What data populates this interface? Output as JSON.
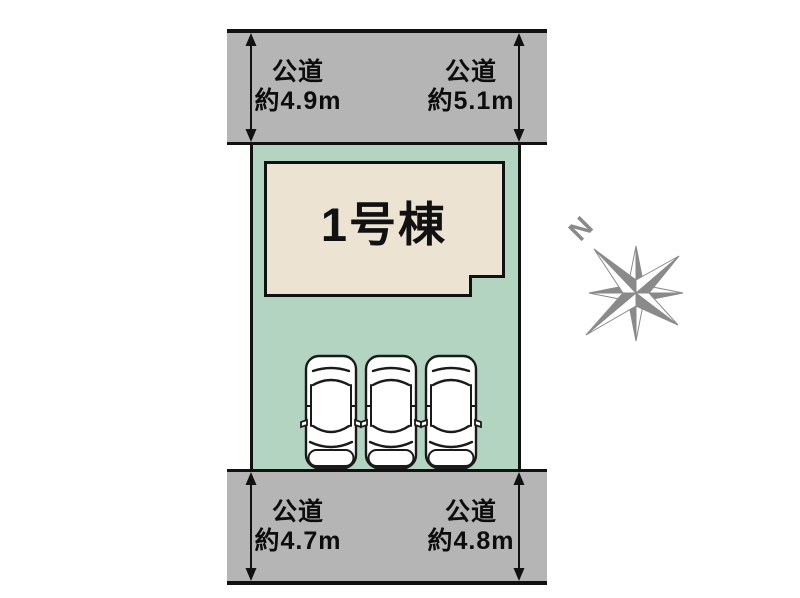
{
  "diagram": {
    "building": {
      "label": "1号棟"
    },
    "compass": {
      "label": "N"
    },
    "roads": {
      "top_left": {
        "name": "公道",
        "width": "約4.9m"
      },
      "top_right": {
        "name": "公道",
        "width": "約5.1m"
      },
      "bottom_left": {
        "name": "公道",
        "width": "約4.7m"
      },
      "bottom_right": {
        "name": "公道",
        "width": "約4.8m"
      }
    },
    "parking": {
      "car_count": 3
    },
    "colors": {
      "road_fill": "#b5b5b5",
      "plot_fill": "#b3d4c1",
      "building_fill": "#ece3d2",
      "outline": "#111111",
      "compass_gray": "#8a8a8a"
    }
  }
}
